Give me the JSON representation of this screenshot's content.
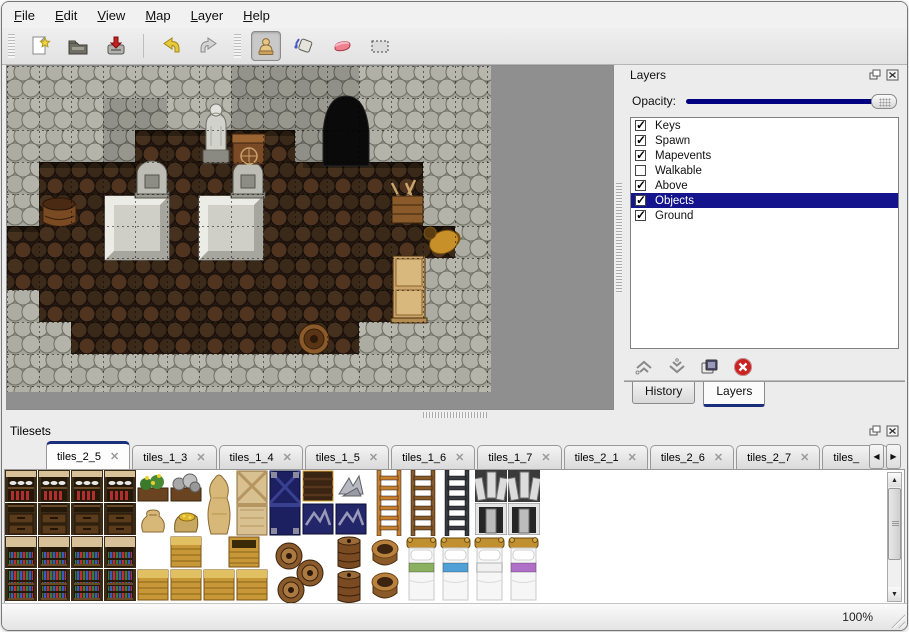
{
  "menu": {
    "items": [
      {
        "label": "File"
      },
      {
        "label": "Edit"
      },
      {
        "label": "View"
      },
      {
        "label": "Map"
      },
      {
        "label": "Layer"
      },
      {
        "label": "Help"
      }
    ]
  },
  "toolbar": {
    "buttons": [
      {
        "name": "new"
      },
      {
        "name": "open"
      },
      {
        "name": "save"
      },
      {
        "name": "undo"
      },
      {
        "name": "redo"
      },
      {
        "name": "stamp",
        "active": true
      },
      {
        "name": "fill"
      },
      {
        "name": "eraser"
      },
      {
        "name": "select"
      }
    ]
  },
  "layers_panel": {
    "title": "Layers",
    "opacity_label": "Opacity:",
    "opacity_fraction": 1.0,
    "layers": [
      {
        "name": "Keys",
        "checked": true,
        "selected": false
      },
      {
        "name": "Spawn",
        "checked": true,
        "selected": false
      },
      {
        "name": "Mapevents",
        "checked": true,
        "selected": false
      },
      {
        "name": "Walkable",
        "checked": false,
        "selected": false
      },
      {
        "name": "Above",
        "checked": true,
        "selected": false
      },
      {
        "name": "Objects",
        "checked": true,
        "selected": true
      },
      {
        "name": "Ground",
        "checked": true,
        "selected": false
      }
    ],
    "action_buttons": [
      "raise-layer",
      "lower-layer",
      "duplicate-layer",
      "delete-layer"
    ],
    "tabs": [
      {
        "label": "History",
        "active": false
      },
      {
        "label": "Layers",
        "active": true
      }
    ]
  },
  "tilesets_panel": {
    "title": "Tilesets",
    "tabs": [
      {
        "label": "tiles_2_5",
        "active": true
      },
      {
        "label": "tiles_1_3",
        "active": false
      },
      {
        "label": "tiles_1_4",
        "active": false
      },
      {
        "label": "tiles_1_5",
        "active": false
      },
      {
        "label": "tiles_1_6",
        "active": false
      },
      {
        "label": "tiles_1_7",
        "active": false
      },
      {
        "label": "tiles_2_1",
        "active": false
      },
      {
        "label": "tiles_2_6",
        "active": false
      },
      {
        "label": "tiles_2_7",
        "active": false
      },
      {
        "label": "tiles_",
        "active": false,
        "truncated": true
      }
    ]
  },
  "status_bar": {
    "zoom_level": "100%"
  },
  "colors": {
    "selection": "#14148c",
    "opacity_track": "#000080",
    "tab_accent": "#1c2f7c",
    "map_background": "#8f8f8f"
  }
}
